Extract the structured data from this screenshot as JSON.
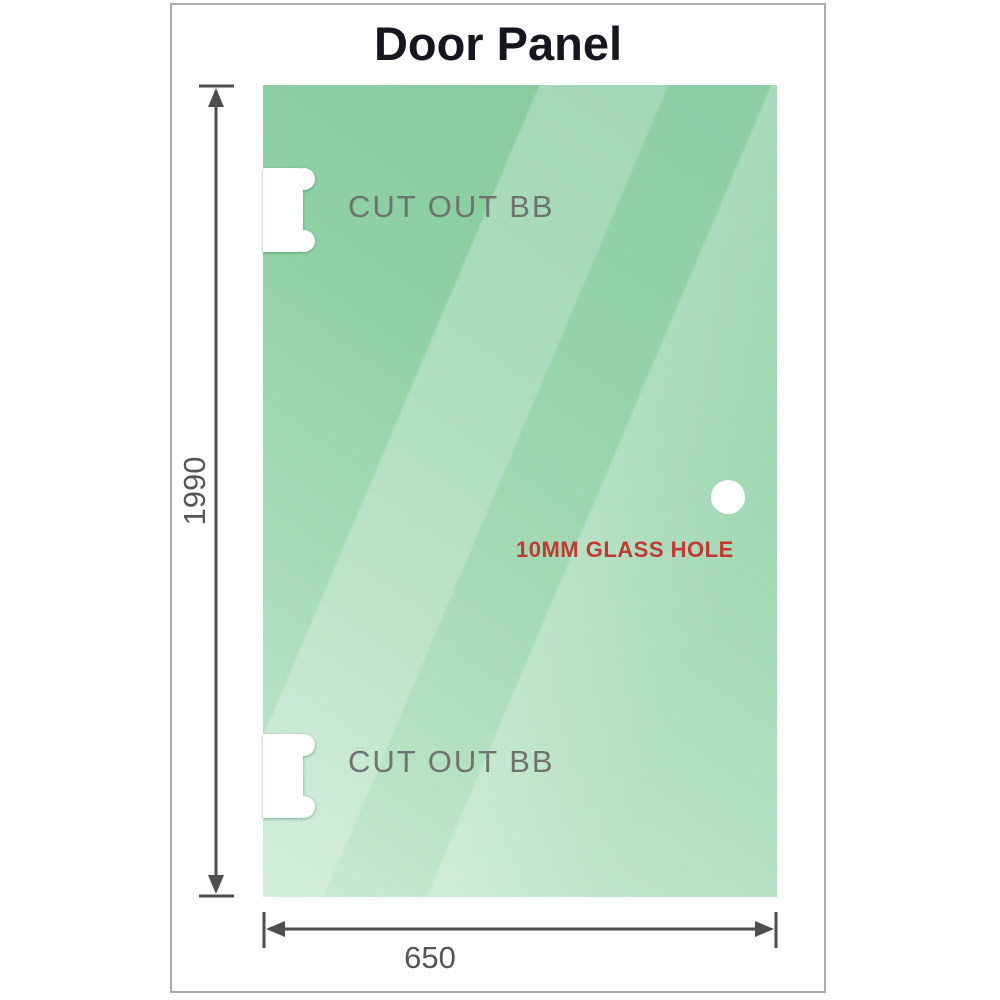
{
  "title": "Door Panel",
  "panel": {
    "labels": {
      "cutout_top": "CUT OUT BB",
      "cutout_bottom": "CUT OUT BB",
      "hole": "10MM GLASS HOLE"
    },
    "dimensions": {
      "height": "1990",
      "width": "650"
    }
  },
  "icons": {
    "cutouts": "hinge-cutout-shape",
    "hole": "glass-hole-circle",
    "dimension_arrows": "double-headed-arrows"
  },
  "colors": {
    "glass_base": "#8ed0a4",
    "glass_dark": "#83c99c",
    "glass_light": "#c6e9d2",
    "frame_border": "#ababab",
    "title_text": "#16161e",
    "cutout_text": "#6e7270",
    "hole_text": "#c13a31",
    "dimension_line": "#4e4e4e",
    "dimension_text": "#565656",
    "background": "#ffffff"
  }
}
